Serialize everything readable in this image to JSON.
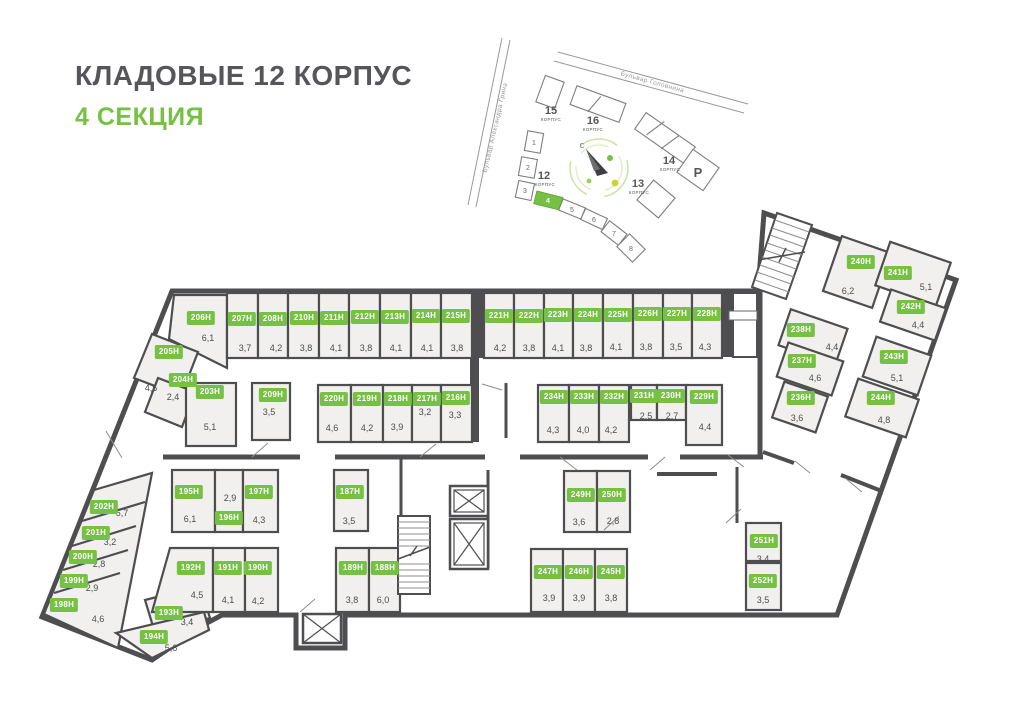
{
  "title": "КЛАДОВЫЕ 12 КОРПУС",
  "subtitle": "4 СЕКЦИЯ",
  "colors": {
    "accent_green": "#76c043",
    "wall": "#4e4e50",
    "room_fill": "#f1f0ee",
    "title_gray": "#55565a"
  },
  "minimap": {
    "streets": [
      "Бульвар Александра Грина",
      "Бульвар Головнина"
    ],
    "compass_north": "С",
    "buildings": [
      {
        "number": "15",
        "sub": "КОРПУС"
      },
      {
        "number": "16",
        "sub": "КОРПУС"
      },
      {
        "number": "14",
        "sub": "КОРПУС"
      },
      {
        "number": "13",
        "sub": "КОРПУС"
      },
      {
        "number": "12",
        "sub": "КОРПУС"
      },
      {
        "number": "Р",
        "sub": ""
      }
    ],
    "sections": [
      "1",
      "2",
      "3",
      "4",
      "5",
      "6",
      "7",
      "8"
    ],
    "active_section": "4"
  },
  "plan": {
    "rooms": [
      {
        "id": "206Н",
        "area": "6,1",
        "chip": [
          201,
          318
        ],
        "label": [
          208,
          338
        ]
      },
      {
        "id": "207Н",
        "area": "3,7",
        "chip": [
          242,
          319
        ],
        "label": [
          245,
          348
        ]
      },
      {
        "id": "208Н",
        "area": "4,2",
        "chip": [
          273,
          319
        ],
        "label": [
          276,
          348
        ]
      },
      {
        "id": "210Н",
        "area": "3,8",
        "chip": [
          304,
          318
        ],
        "label": [
          306,
          348
        ]
      },
      {
        "id": "211Н",
        "area": "4,1",
        "chip": [
          334,
          318
        ],
        "label": [
          336,
          348
        ]
      },
      {
        "id": "212Н",
        "area": "3,8",
        "chip": [
          365,
          317
        ],
        "label": [
          366,
          348
        ]
      },
      {
        "id": "213Н",
        "area": "4,1",
        "chip": [
          395,
          317
        ],
        "label": [
          396,
          348
        ]
      },
      {
        "id": "214Н",
        "area": "4,1",
        "chip": [
          426,
          316
        ],
        "label": [
          427,
          348
        ]
      },
      {
        "id": "215Н",
        "area": "3,8",
        "chip": [
          456,
          316
        ],
        "label": [
          457,
          348
        ]
      },
      {
        "id": "221Н",
        "area": "4,2",
        "chip": [
          499,
          316
        ],
        "label": [
          500,
          348
        ]
      },
      {
        "id": "222Н",
        "area": "3,8",
        "chip": [
          529,
          316
        ],
        "label": [
          529,
          348
        ]
      },
      {
        "id": "223Н",
        "area": "4,1",
        "chip": [
          558,
          315
        ],
        "label": [
          558,
          348
        ]
      },
      {
        "id": "224Н",
        "area": "3,8",
        "chip": [
          588,
          315
        ],
        "label": [
          586,
          348
        ]
      },
      {
        "id": "225Н",
        "area": "4,1",
        "chip": [
          618,
          315
        ],
        "label": [
          616,
          347
        ]
      },
      {
        "id": "226Н",
        "area": "3,8",
        "chip": [
          648,
          314
        ],
        "label": [
          646,
          347
        ]
      },
      {
        "id": "227Н",
        "area": "3,5",
        "chip": [
          677,
          314
        ],
        "label": [
          676,
          347
        ]
      },
      {
        "id": "228Н",
        "area": "4,3",
        "chip": [
          707,
          314
        ],
        "label": [
          705,
          347
        ]
      },
      {
        "id": "205Н",
        "area": "4,5",
        "chip": [
          169,
          352
        ],
        "label": [
          151,
          388
        ]
      },
      {
        "id": "204Н",
        "area": "2,4",
        "chip": [
          183,
          380
        ],
        "label": [
          173,
          397
        ]
      },
      {
        "id": "203Н",
        "area": "5,1",
        "chip": [
          210,
          392
        ],
        "label": [
          210,
          427
        ]
      },
      {
        "id": "209Н",
        "area": "3,5",
        "chip": [
          273,
          395
        ],
        "label": [
          269,
          412
        ]
      },
      {
        "id": "220Н",
        "area": "4,6",
        "chip": [
          334,
          399
        ],
        "label": [
          332,
          428
        ]
      },
      {
        "id": "219Н",
        "area": "4,2",
        "chip": [
          367,
          399
        ],
        "label": [
          367,
          428
        ]
      },
      {
        "id": "218Н",
        "area": "3,9",
        "chip": [
          398,
          399
        ],
        "label": [
          397,
          427
        ]
      },
      {
        "id": "217Н",
        "area": "3,2",
        "chip": [
          427,
          399
        ],
        "label": [
          425,
          412
        ]
      },
      {
        "id": "216Н",
        "area": "3,3",
        "chip": [
          456,
          398
        ],
        "label": [
          455,
          415
        ]
      },
      {
        "id": "234Н",
        "area": "4,3",
        "chip": [
          554,
          397
        ],
        "label": [
          553,
          430
        ]
      },
      {
        "id": "233Н",
        "area": "4,0",
        "chip": [
          584,
          397
        ],
        "label": [
          583,
          430
        ]
      },
      {
        "id": "232Н",
        "area": "4,2",
        "chip": [
          614,
          397
        ],
        "label": [
          611,
          430
        ]
      },
      {
        "id": "231Н",
        "area": "2,5",
        "chip": [
          644,
          396
        ],
        "label": [
          646,
          416
        ]
      },
      {
        "id": "230Н",
        "area": "2,7",
        "chip": [
          671,
          396
        ],
        "label": [
          672,
          416
        ]
      },
      {
        "id": "229Н",
        "area": "4,4",
        "chip": [
          704,
          397
        ],
        "label": [
          705,
          427
        ]
      },
      {
        "id": "240Н",
        "area": "6,2",
        "chip": [
          861,
          262
        ],
        "label": [
          848,
          291
        ]
      },
      {
        "id": "241Н",
        "area": "5,1",
        "chip": [
          898,
          273
        ],
        "label": [
          926,
          287
        ]
      },
      {
        "id": "242Н",
        "area": "4,4",
        "chip": [
          911,
          307
        ],
        "label": [
          918,
          325
        ]
      },
      {
        "id": "238Н",
        "area": "4,4",
        "chip": [
          801,
          330
        ],
        "label": [
          832,
          347
        ]
      },
      {
        "id": "237Н",
        "area": "4,6",
        "chip": [
          802,
          361
        ],
        "label": [
          815,
          378
        ]
      },
      {
        "id": "243Н",
        "area": "5,1",
        "chip": [
          894,
          357
        ],
        "label": [
          897,
          378
        ]
      },
      {
        "id": "236Н",
        "area": "3,6",
        "chip": [
          801,
          398
        ],
        "label": [
          797,
          418
        ]
      },
      {
        "id": "244Н",
        "area": "4,8",
        "chip": [
          881,
          398
        ],
        "label": [
          884,
          420
        ]
      },
      {
        "id": "202Н",
        "area": "5,7",
        "chip": [
          104,
          507
        ],
        "label": [
          122,
          513
        ]
      },
      {
        "id": "201Н",
        "area": "3,2",
        "chip": [
          96,
          533
        ],
        "label": [
          110,
          542
        ]
      },
      {
        "id": "200Н",
        "area": "2,8",
        "chip": [
          83,
          557
        ],
        "label": [
          99,
          564
        ]
      },
      {
        "id": "199Н",
        "area": "2,9",
        "chip": [
          74,
          581
        ],
        "label": [
          92,
          588
        ]
      },
      {
        "id": "198Н",
        "area": "4,6",
        "chip": [
          64,
          605
        ],
        "label": [
          98,
          619
        ]
      },
      {
        "id": "195Н",
        "area": "6,1",
        "chip": [
          189,
          492
        ],
        "label": [
          190,
          519
        ]
      },
      {
        "id": "196Н",
        "area": "2,9",
        "chip": [
          229,
          518
        ],
        "label": [
          230,
          498
        ]
      },
      {
        "id": "197Н",
        "area": "4,3",
        "chip": [
          259,
          492
        ],
        "label": [
          259,
          520
        ]
      },
      {
        "id": "192Н",
        "area": "4,5",
        "chip": [
          191,
          568
        ],
        "label": [
          197,
          595
        ]
      },
      {
        "id": "191Н",
        "area": "4,1",
        "chip": [
          228,
          568
        ],
        "label": [
          228,
          600
        ]
      },
      {
        "id": "190Н",
        "area": "4,2",
        "chip": [
          258,
          568
        ],
        "label": [
          258,
          601
        ]
      },
      {
        "id": "193Н",
        "area": "3,4",
        "chip": [
          169,
          613
        ],
        "label": [
          187,
          622
        ]
      },
      {
        "id": "194Н",
        "area": "5,6",
        "chip": [
          154,
          637
        ],
        "label": [
          171,
          648
        ]
      },
      {
        "id": "187Н",
        "area": "3,5",
        "chip": [
          350,
          492
        ],
        "label": [
          349,
          521
        ]
      },
      {
        "id": "189Н",
        "area": "3,8",
        "chip": [
          353,
          568
        ],
        "label": [
          352,
          600
        ]
      },
      {
        "id": "188Н",
        "area": "6,0",
        "chip": [
          385,
          568
        ],
        "label": [
          383,
          600
        ]
      },
      {
        "id": "249Н",
        "area": "3,6",
        "chip": [
          581,
          495
        ],
        "label": [
          579,
          522
        ]
      },
      {
        "id": "250Н",
        "area": "2,8",
        "chip": [
          612,
          495
        ],
        "label": [
          613,
          521
        ]
      },
      {
        "id": "247Н",
        "area": "3,9",
        "chip": [
          548,
          572
        ],
        "label": [
          549,
          598
        ]
      },
      {
        "id": "246Н",
        "area": "3,9",
        "chip": [
          579,
          572
        ],
        "label": [
          579,
          598
        ]
      },
      {
        "id": "245Н",
        "area": "3,8",
        "chip": [
          611,
          572
        ],
        "label": [
          611,
          598
        ]
      },
      {
        "id": "251Н",
        "area": "3,4",
        "chip": [
          764,
          541
        ],
        "label": [
          763,
          559
        ]
      },
      {
        "id": "252Н",
        "area": "3,5",
        "chip": [
          763,
          581
        ],
        "label": [
          763,
          600
        ]
      }
    ]
  }
}
